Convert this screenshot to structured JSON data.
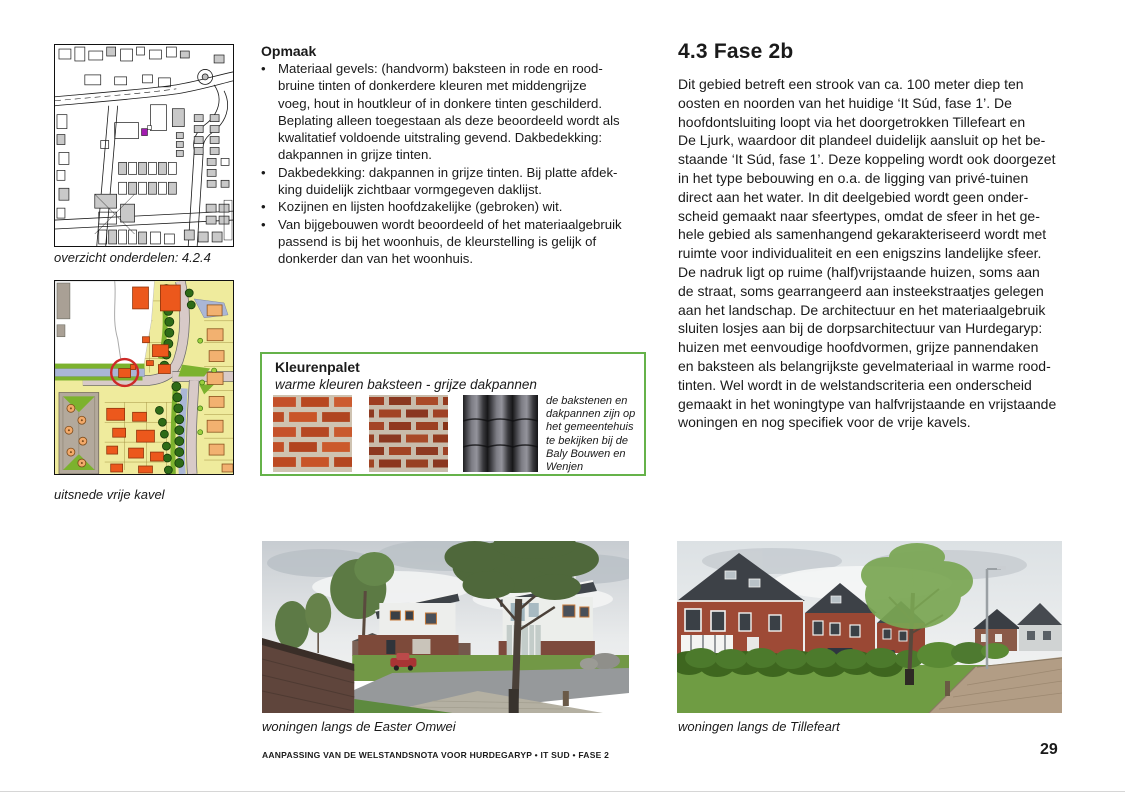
{
  "document": {
    "footer": "AANPASSING VAN DE WELSTANDSNOTA VOOR HURDEGARYP • IT SUD • FASE 2",
    "page_number": "29"
  },
  "left_column": {
    "overview_caption": "overzicht onderdelen: 4.2.4",
    "detail_caption": "uitsnede vrije kavel"
  },
  "opmaak": {
    "heading": "Opmaak",
    "bullet_marker": "•",
    "bullets": [
      [
        "Materiaal gevels: (handvorm) baksteen in rode en rood-",
        "bruine tinten of donkerdere kleuren met middengrijze",
        "voeg, hout in houtkleur of in donkere tinten geschilderd.",
        "Beplating alleen toegestaan als deze beoordeeld wordt als",
        "kwalitatief voldoende uitstraling gevend. Dakbedekking:",
        "dakpannen in grijze tinten."
      ],
      [
        "Dakbedekking: dakpannen in grijze tinten. Bij platte afdek-",
        "king duidelijk zichtbaar vormgegeven daklijst."
      ],
      [
        "Kozijnen en lijsten hoofdzakelijke (gebroken) wit."
      ],
      [
        "Van bijgebouwen wordt beoordeeld of het materiaalgebruik",
        "passend is bij het woonhuis, de kleurstelling is gelijk of",
        "donkerder dan van het woonhuis."
      ]
    ]
  },
  "kleurenpalet": {
    "title": "Kleurenpalet",
    "subtitle": "warme kleuren baksteen - grijze dakpannen",
    "note": [
      "de bakstenen en",
      "dakpannen zijn op",
      "het gemeentehuis",
      "te bekijken bij de",
      "Baly Bouwen en",
      "Wenjen"
    ],
    "swatches": [
      "rode baksteen",
      "roodbruine baksteen",
      "grijze dakpannen"
    ],
    "border_color": "#65b24a"
  },
  "fase2b": {
    "title": "4.3 Fase 2b",
    "body": [
      "Dit gebied betreft een strook van ca. 100 meter diep ten",
      "oosten en noorden van het huidige ‘It Súd, fase 1’. De",
      "hoofdontsluiting loopt via het doorgetrokken Tillefeart en",
      "De Ljurk, waardoor dit plandeel duidelijk aansluit op het be-",
      "staande ‘It Súd, fase 1’. Deze koppeling wordt ook doorgezet",
      "in het type bebouwing en o.a. de ligging van privé-tuinen",
      "direct aan het water. In dit deelgebied wordt geen onder-",
      "scheid gemaakt naar sfeertypes, omdat de sfeer in het ge-",
      "hele gebied als samenhangend gekarakteriseerd wordt met",
      "ruimte voor individualiteit en een enigszins landelijke sfeer.",
      "De nadruk ligt op ruime (half)vrijstaande huizen, soms aan",
      "de straat, soms gearrangeerd aan insteekstraatjes gelegen",
      "aan het landschap. De architectuur en het materiaalgebruik",
      "sluiten losjes aan bij de dorpsarchitectuur van Hurdegaryp:",
      "huizen met eenvoudige hoofdvormen, grijze pannendaken",
      "en baksteen als belangrijkste gevelmateriaal in warme rood-",
      "tinten. Wel wordt in de welstandscriteria een onderscheid",
      "gemaakt in het woningtype van halfvrijstaande en vrijstaande",
      "woningen en nog specifiek voor de vrije kavels."
    ]
  },
  "photos": {
    "left_caption": "woningen langs de Easter Omwei",
    "right_caption": "woningen langs de Tillefeart"
  },
  "colors": {
    "palette_border": "#65b24a",
    "highlight_circle": "#cd2a28",
    "map_marker_magenta": "#a21caf"
  }
}
